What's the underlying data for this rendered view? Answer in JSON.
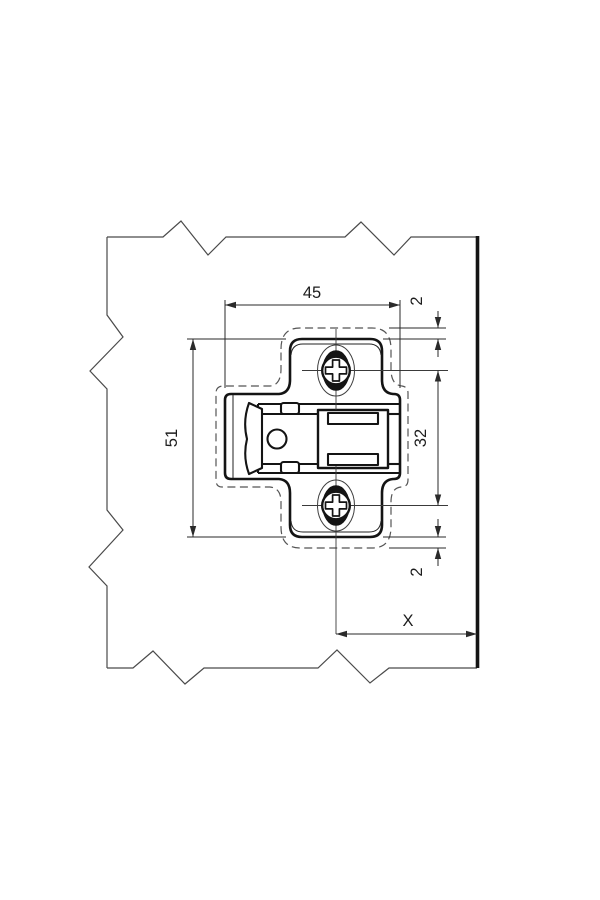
{
  "drawing": {
    "kind": "technical-dimension-drawing",
    "colors": {
      "line": "#141414",
      "background": "#ffffff"
    },
    "dimensions": {
      "plate_width": "45",
      "top_overhang": "2",
      "plate_height": "51",
      "hole_spacing": "32",
      "bottom_overhang": "2",
      "edge_distance": "X"
    }
  }
}
